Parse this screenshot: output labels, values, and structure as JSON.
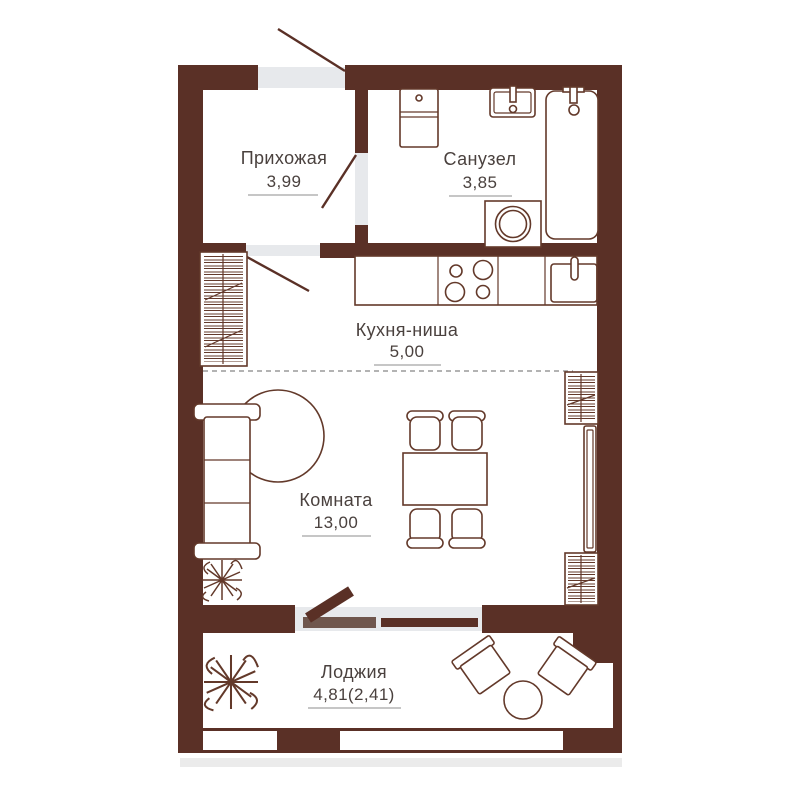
{
  "colors": {
    "wall": "#5a3026",
    "outline": "#63392a",
    "opening": "#e7e9ec",
    "sill": "#6f564d",
    "text": "#4a413e",
    "underline": "#b3b3b3",
    "dashed": "#9a9a9a",
    "shadow": "#ebebeb"
  },
  "rooms": [
    {
      "id": "hallway",
      "name": "Прихожая",
      "area": "3,99"
    },
    {
      "id": "bathroom",
      "name": "Санузел",
      "area": "3,85"
    },
    {
      "id": "kitchen",
      "name": "Кухня-ниша",
      "area": "5,00"
    },
    {
      "id": "living-room",
      "name": "Комната",
      "area": "13,00"
    },
    {
      "id": "loggia",
      "name": "Лоджия",
      "area": "4,81(2,41)"
    }
  ],
  "fixtures": [
    "entrance-door",
    "interior-door",
    "bathroom-door",
    "balcony-door",
    "window",
    "toilet",
    "washbasin",
    "bathtub",
    "washing-machine",
    "kitchen-counter",
    "stove",
    "kitchen-sink",
    "wardrobe",
    "panel",
    "sofa",
    "round-rug",
    "plant",
    "dining-table",
    "chair",
    "armchair",
    "coffee-table"
  ]
}
